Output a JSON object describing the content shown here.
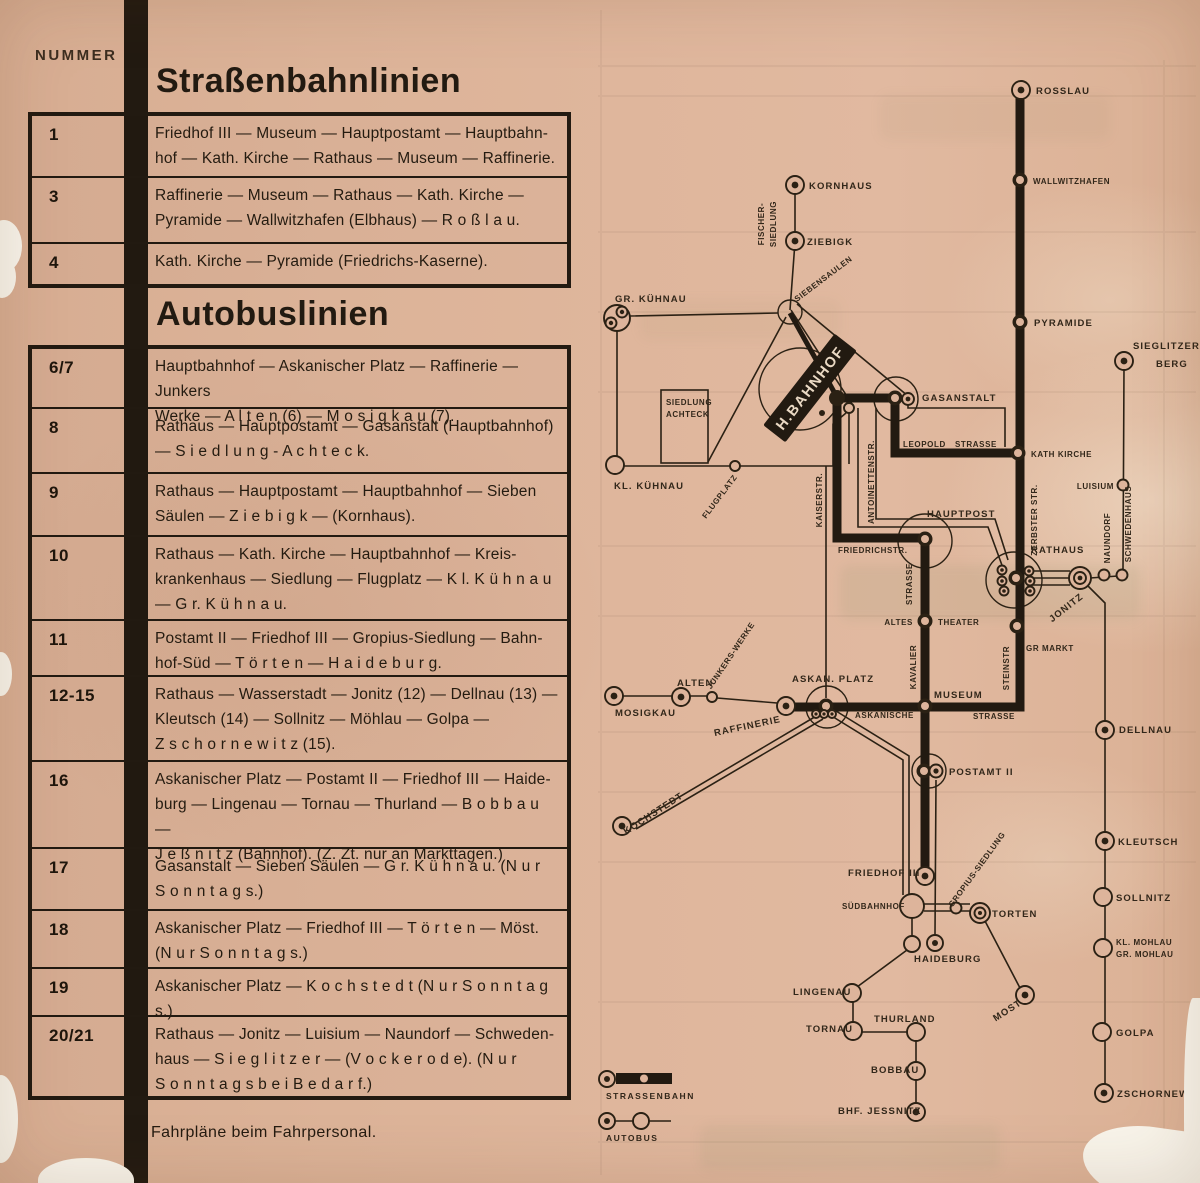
{
  "page": {
    "nummer_label": "NUMMER",
    "tram_title": "Straßenbahnlinien",
    "bus_title": "Autobuslinien",
    "footer_note": "Fahrpläne beim Fahrpersonal."
  },
  "tram_lines": [
    {
      "number": "1",
      "route": "Friedhof III — Museum — Hauptpostamt — Hauptbahn-\nhof — Kath. Kirche — Rathaus — Museum — Raffinerie."
    },
    {
      "number": "3",
      "route": "Raffinerie — Museum — Rathaus — Kath. Kirche —\nPyramide — Wallwitzhafen (Elbhaus) — R o ß l a u."
    },
    {
      "number": "4",
      "route": "Kath. Kirche — Pyramide (Friedrichs-Kaserne)."
    }
  ],
  "bus_lines": [
    {
      "number": "6/7",
      "route": "Hauptbahnhof — Askanischer Platz — Raffinerie — Junkers\nWerke — A l t e n (6) — M o s i g k a u (7)."
    },
    {
      "number": "8",
      "route": "Rathaus — Hauptpostamt — Gasanstalt (Hauptbahnhof)\n— S i e d l u n g - A c h t e c k."
    },
    {
      "number": "9",
      "route": "Rathaus — Hauptpostamt — Hauptbahnhof — Sieben\nSäulen — Z i e b i g k — (Kornhaus)."
    },
    {
      "number": "10",
      "route": "Rathaus — Kath. Kirche — Hauptbahnhof — Kreis-\nkrankenhaus — Siedlung — Flugplatz — K l. K ü h n a u\n— G r. K ü h n a u."
    },
    {
      "number": "11",
      "route": "Postamt II — Friedhof III — Gropius-Siedlung — Bahn-\nhof-Süd — T ö r t e n — H a i d e b u r g."
    },
    {
      "number": "12-15",
      "route": "Rathaus — Wasserstadt — Jonitz (12) — Dellnau (13) —\nKleutsch (14) — Sollnitz — Möhlau — Golpa —\nZ s c h o r n e w i t z (15)."
    },
    {
      "number": "16",
      "route": "Askanischer Platz — Postamt II — Friedhof III — Haide-\nburg — Lingenau — Tornau — Thurland — B o b b a u —\nJ e ß n i t z (Bahnhof).  (Z. Zt. nur an Markttagen.)"
    },
    {
      "number": "17",
      "route": "Gasanstalt — Sieben Säulen — G r. K ü h n a u. (N u r\nS o n n t a g s.)"
    },
    {
      "number": "18",
      "route": "Askanischer Platz — Friedhof III — T ö r t e n — Möst.\n(N u r S o n n t a g s.)"
    },
    {
      "number": "19",
      "route": "Askanischer Platz — K o c h s t e d t (N u r S o n n t a g s.)"
    },
    {
      "number": "20/21",
      "route": "Rathaus — Jonitz — Luisium — Naundorf — Schweden-\nhaus — S i e g l i t z e r — (V o c k e r o d e).  (N u r\nS o n n t a g s  b e i  B e d a r f.)"
    }
  ],
  "legend": {
    "tram": "STRASSENBAHN",
    "bus": "AUTOBUS"
  },
  "map": {
    "labels": {
      "rosslau": "ROSSLAU",
      "wallwitzhafen": "WALLWITZHAFEN",
      "kornhaus": "KORNHAUS",
      "ziebigk": "ZIEBIGK",
      "fischer_line1": "FISCHER-",
      "fischer_line2": "SIEDLUNG",
      "siebensaulen": "SIEBENSAULEN",
      "gr_kuhnau": "GR. KÜHNAU",
      "kl_kuhnau": "KL. KÜHNAU",
      "achteck_line1": "SIEDLUNG",
      "achteck_line2": "ACHTECK",
      "flugplatz": "FLUGPLATZ",
      "h_bahnhof": "H.BAHNHOF",
      "pyramide": "PYRAMIDE",
      "sieglitzer_line1": "SIEGLITZER",
      "sieglitzer_line2": "BERG",
      "gasanstalt": "GASANSTALT",
      "leopold": "LEOPOLD",
      "leopold_strasse": "STRASSE",
      "kath_kirche": "KATH KIRCHE",
      "kaiserstr": "KAISERSTR.",
      "antoinettenstr": "ANTOINETTENSTR.",
      "zerbster_str": "ZERBSTER STR.",
      "hauptpost": "HAUPTPOST",
      "friedrichstr": "FRIEDRICHSTR.",
      "luisium": "LUISIUM",
      "naundorf": "NAUNDORF",
      "schwedenhaus": "SCHWEDENHAUS",
      "rathaus": "RATHAUS",
      "jonitz": "JONITZ",
      "kavalier": "KAVALIER",
      "kavalier_strasse": "STRASSE",
      "altes": "ALTES",
      "theater": "THEATER",
      "gr_markt": "GR MARKT",
      "steinstr": "STEINSTR",
      "museum": "MUSEUM",
      "askan_platz": "ASKAN. PLATZ",
      "askanische": "ASKANISCHE",
      "askanische_strasse": "STRASSE",
      "alten": "ALTEN",
      "mosigkau": "MOSIGKAU",
      "junkers_werke": "JUNKERS-WERKE",
      "raffinerie": "RAFFINERIE",
      "kochstedt": "KOCHSTEDT",
      "postamt_2": "POSTAMT II",
      "friedhof_3": "FRIEDHOF III",
      "suedbahnhof": "SÜDBAHNHOF",
      "gropius": "GROPIUS-SIEDLUNG",
      "torten": "TORTEN",
      "haideburg": "HAIDEBURG",
      "lingenau": "LINGENAU",
      "tornau": "TORNAU",
      "thurland": "THURLAND",
      "bobbau": "BOBBAU",
      "bhf_jessnitz": "BHF. JESSNITZ",
      "most": "MOST",
      "dellnau": "DELLNAU",
      "kleutsch": "KLEUTSCH",
      "sollnitz": "SOLLNITZ",
      "mohlau_line1": "KL. MOHLAU",
      "mohlau_line2": "GR. MOHLAU",
      "golpa": "GOLPA",
      "zschornewitz": "ZSCHORNEWITZ"
    }
  },
  "colors": {
    "paper": "#ddb49b",
    "ink": "#221a11",
    "map_ink": "#2b2114"
  }
}
